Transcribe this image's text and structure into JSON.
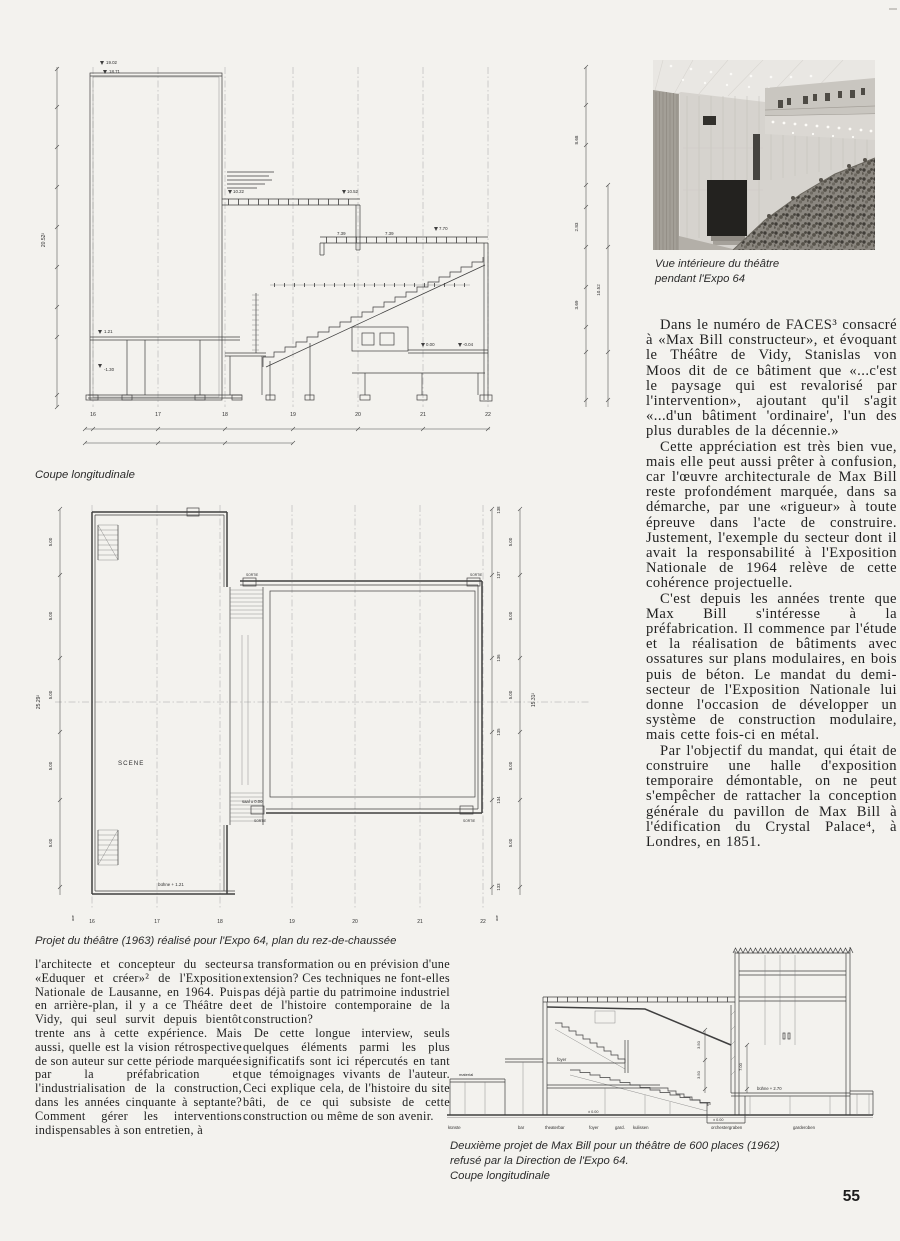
{
  "page": {
    "number": "55"
  },
  "photo": {
    "caption_line1": "Vue intérieure du théâtre",
    "caption_line2": "pendant l'Expo 64"
  },
  "right_column": {
    "paragraphs": [
      "Dans le numéro de FACES³ consacré à «Max Bill constructeur», et évoquant le Théâtre de Vidy, Stanislas von Moos dit de ce bâtiment que «...c'est le paysage qui est revalorisé par l'intervention», ajoutant qu'il s'agit «...d'un bâtiment 'ordinaire', l'un des plus durables de la décennie.»",
      "Cette appréciation est très bien vue, mais elle peut aussi prêter à confusion, car l'œuvre architecturale de Max Bill reste profondément marquée, dans sa démarche, par une «rigueur» à toute épreuve dans l'acte de construire. Justement, l'exemple du secteur dont il avait la responsabilité à l'Exposition Nationale de 1964 relève de cette cohérence projectuelle.",
      "C'est depuis les années trente que Max Bill s'intéresse à la préfabrication. Il commence par l'étude et la réalisation de bâtiments avec ossatures sur plans modulaires, en bois puis de béton. Le mandat du demi-secteur de l'Exposition Nationale lui donne l'occasion de développer un système de construction modulaire, mais cette fois-ci en métal.",
      "Par l'objectif du mandat, qui était de construire une halle d'exposition temporaire démontable, on ne peut s'empêcher de rattacher la conception générale du pavillon de Max Bill à l'édification du Crystal Palace⁴, à Londres, en 1851."
    ]
  },
  "bottom_left": {
    "col1": "l'architecte et concepteur du secteur «Eduquer et créer»² de l'Exposition Nationale de Lausanne, en 1964. Puis en arrière-plan, il y a ce Théâtre de Vidy, qui seul survit depuis bientôt trente ans à cette expérience. Mais aussi, quelle est la vision rétrospective de son auteur sur cette période marquée par la préfabrication et l'industrialisation de la construction, dans les années cinquante à septante? Comment gérer les interventions indispensables à son entretien, à",
    "col2_p1": "sa transformation ou en prévision d'une extension? Ces techniques ne font-elles pas déjà partie du patrimoine industriel et de l'histoire contemporaine de la construction?",
    "col2_p2": "De cette longue interview, seuls quelques éléments parmi les plus significatifs sont ici répercutés en tant que témoignages vivants de l'auteur. Ceci explique cela, de l'histoire du site bâti, de ce qui subsiste de cette construction ou même de son avenir."
  },
  "drawings": {
    "section_top": {
      "caption": "Coupe longitudinale",
      "grid_labels": [
        "16",
        "17",
        "18",
        "19",
        "20",
        "21",
        "22"
      ],
      "labels": {
        "elev1": "19.02",
        "elev2": "18.71",
        "left_total": "20.52²",
        "roof_mid_left": "10.22",
        "roof_mid_right": "10.52",
        "roof_low_a": "7.39",
        "roof_low_b": "7.39",
        "roof_low_c": "7.70",
        "stage_level": "1.21",
        "basement_level": "-1.30",
        "hall_level": "0.00",
        "right_level": "-0.04",
        "dim_a": "8.68",
        "dim_b": "2.83",
        "dim_c": "10.52",
        "dim_d": "3.69"
      }
    },
    "plan": {
      "caption": "Projet du théâtre (1963) réalisé pour l'Expo 64, plan du rez-de-chaussée",
      "grid_labels": [
        "16",
        "17",
        "18",
        "19",
        "20",
        "21",
        "22"
      ],
      "row_labels": [
        "138",
        "137",
        "136",
        "135",
        "134",
        "133"
      ],
      "dim_5": "5.00",
      "left_total": "25.29²",
      "right_total": "15.31²",
      "axis_label": "axe",
      "labels": {
        "scene": "SCENE",
        "saal": "saal ± 0.00",
        "buehne": "bühne + 1.21",
        "sortie": "SORTIE"
      }
    },
    "section_bottom": {
      "caption_line1": "Deuxième projet de Max Bill pour un théâtre de 600 places (1962)",
      "caption_line2": "refusé par la Direction de l'Expo 64.",
      "caption_line3": "Coupe longitudinale",
      "room_labels": [
        "künste",
        "bar",
        "theaterbar",
        "foyer",
        "gard.",
        "kulissen",
        "orchestergraben",
        "garderoben"
      ],
      "labels": {
        "material": "material",
        "foyer": "foyer",
        "buehne": "bühne + 2.70",
        "zero_a": "± 0.00",
        "zero_b": "± 0.00",
        "dim_a": "3.50",
        "dim_b": "3.50",
        "dim_c": "7.00"
      }
    }
  }
}
